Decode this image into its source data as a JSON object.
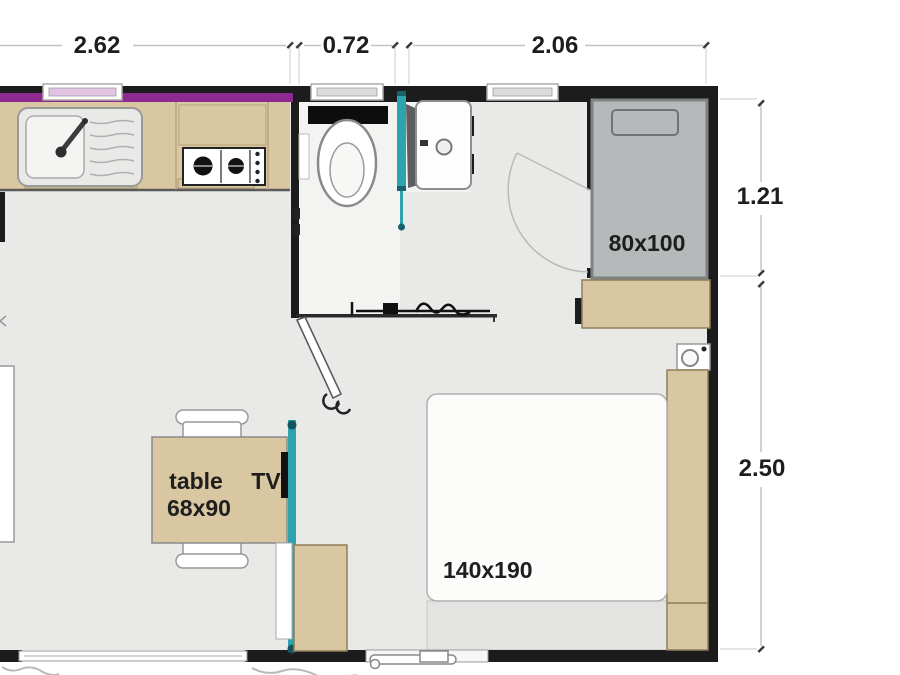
{
  "floorplan": {
    "dimensions": {
      "top": [
        {
          "value": "2.62"
        },
        {
          "value": "0.72"
        },
        {
          "value": "2.06"
        }
      ],
      "right": [
        {
          "value": "1.21"
        },
        {
          "value": "2.50"
        }
      ]
    },
    "rooms": {
      "small_bed_label": "80x100",
      "large_bed_label": "140x190",
      "table_label": "table",
      "table_size_label": "68x90",
      "tv_label": "TV"
    },
    "colors": {
      "wall": "#1c1c1c",
      "accent_purple": "#8e2a8f",
      "wood": "#d9c7a1",
      "teal": "#2fa3ad",
      "bed_gray": "#b6b9b9",
      "floor": "#e9e9e7",
      "dim_text": "#1e1e1e"
    }
  }
}
